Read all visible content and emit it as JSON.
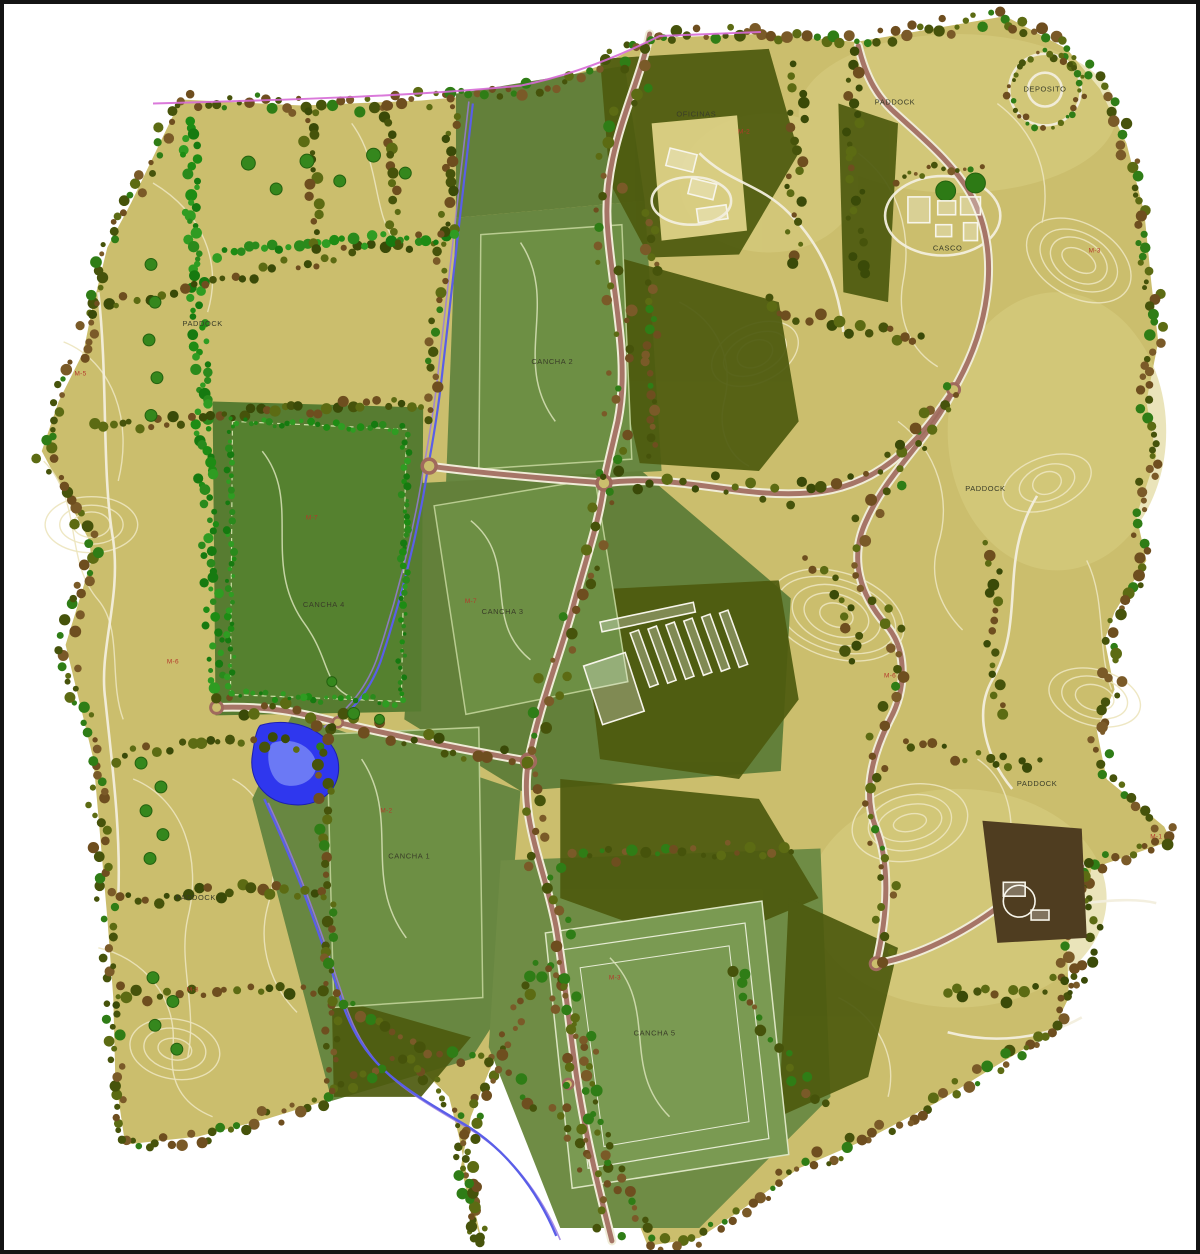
{
  "map": {
    "labels": {
      "paddock": "PADDOCK",
      "canchas": {
        "c1": "CANCHA 1",
        "c2": "CANCHA 2",
        "c3": "CANCHA 3",
        "c4": "CANCHA 4",
        "c5": "CANCHA 5"
      },
      "buildings": {
        "offices": "OFICINAS",
        "casco": "CASCO",
        "deposito": "DEPOSITO"
      },
      "parcels": [
        "M-2",
        "M-5",
        "M-7",
        "M-7",
        "M-2",
        "M-3",
        "M-6",
        "M-6",
        "M-8",
        "M-3",
        "M-1"
      ]
    },
    "colors": {
      "frame": "#141414",
      "paddock": "#cbbe6d",
      "paddock_light": "#d9ce82",
      "field_green": "#6d8f44",
      "field_green_deep": "#55812f",
      "field_green_pale": "#7a9a52",
      "zone_green": "#688741",
      "forest": "#4d5a0e",
      "tree_bright": "#1e8c14",
      "tree_brown": "#6e4e1f",
      "road": "#a06a5d",
      "track": "#f2eedd",
      "contour": "#ece4bc",
      "water": "#2f37ee",
      "stream": "#5a5ee8",
      "boundary": "#d66ad6",
      "ink": "#3a3d28",
      "red": "#b4392b",
      "compound_brown": "#4f3d20"
    }
  }
}
